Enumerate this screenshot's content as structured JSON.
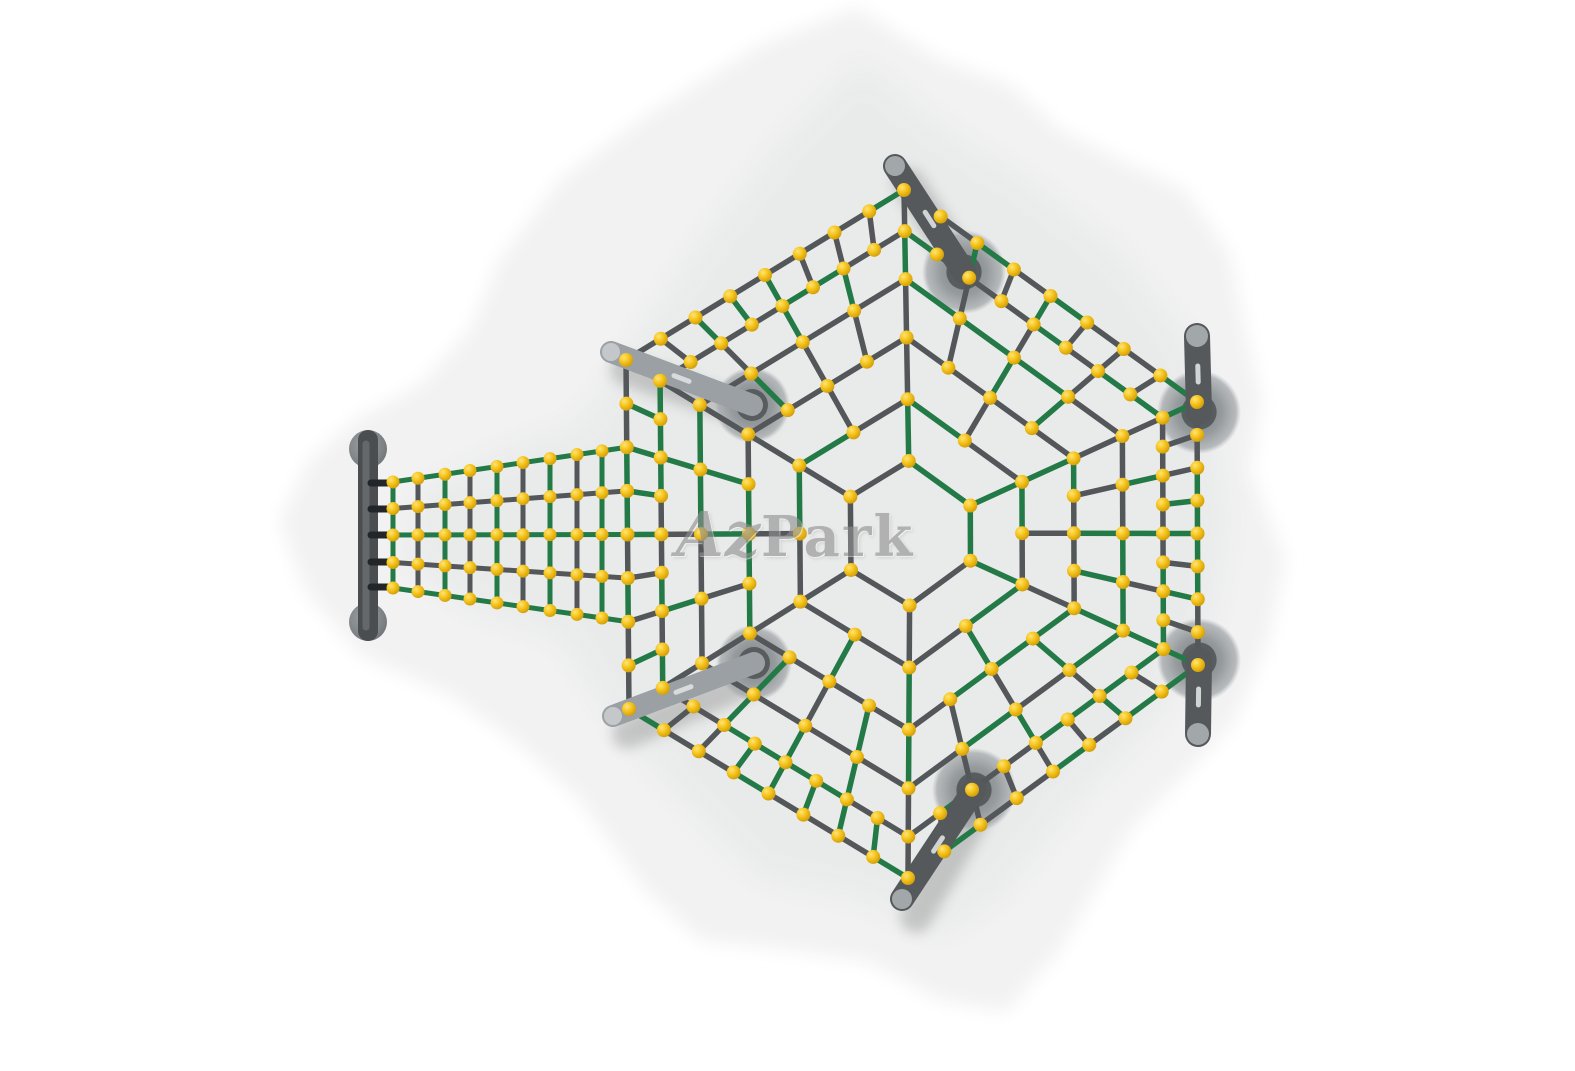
{
  "scene": {
    "watermark": {
      "script": "Az",
      "serif": "Park"
    },
    "colors": {
      "background": "#ffffff",
      "ground_outer": "#f2f2f3",
      "ground_inner": "#e9eaea",
      "rope_gray": "#53575a",
      "rope_green": "#237a47",
      "ball_light": "#ffe476",
      "ball_mid": "#f6c51f",
      "ball_dark": "#cf9a05",
      "post_dark": "#55595b",
      "post_light": "#9aa0a3",
      "post_tip": "#a7acae",
      "base_gray": "#888d8f",
      "base_hole": "#54585a",
      "bar_dark": "#4a4e50",
      "bar_sheen": "#64686a",
      "cap_gray": "#84898b",
      "clamp_black": "#232628",
      "link_silver": "#d6d8d9"
    },
    "ground": {
      "outer": [
        [
          857,
          8
        ],
        [
          940,
          60
        ],
        [
          1010,
          85
        ],
        [
          1060,
          130
        ],
        [
          1120,
          160
        ],
        [
          1185,
          190
        ],
        [
          1230,
          255
        ],
        [
          1245,
          330
        ],
        [
          1262,
          400
        ],
        [
          1250,
          470
        ],
        [
          1285,
          560
        ],
        [
          1268,
          640
        ],
        [
          1235,
          720
        ],
        [
          1180,
          780
        ],
        [
          1130,
          830
        ],
        [
          1060,
          950
        ],
        [
          1005,
          1012
        ],
        [
          940,
          1000
        ],
        [
          870,
          962
        ],
        [
          790,
          950
        ],
        [
          700,
          940
        ],
        [
          645,
          890
        ],
        [
          580,
          800
        ],
        [
          520,
          745
        ],
        [
          450,
          695
        ],
        [
          360,
          655
        ],
        [
          305,
          590
        ],
        [
          280,
          520
        ],
        [
          310,
          460
        ],
        [
          355,
          420
        ],
        [
          420,
          385
        ],
        [
          470,
          330
        ],
        [
          500,
          260
        ],
        [
          560,
          180
        ],
        [
          640,
          120
        ],
        [
          760,
          45
        ]
      ],
      "inner": [
        [
          860,
          60
        ],
        [
          950,
          130
        ],
        [
          1030,
          180
        ],
        [
          1120,
          250
        ],
        [
          1190,
          340
        ],
        [
          1215,
          420
        ],
        [
          1230,
          520
        ],
        [
          1215,
          620
        ],
        [
          1160,
          720
        ],
        [
          1080,
          800
        ],
        [
          1000,
          900
        ],
        [
          938,
          938
        ],
        [
          860,
          900
        ],
        [
          760,
          880
        ],
        [
          680,
          800
        ],
        [
          610,
          720
        ],
        [
          560,
          640
        ],
        [
          470,
          610
        ],
        [
          400,
          560
        ],
        [
          420,
          490
        ],
        [
          500,
          450
        ],
        [
          580,
          420
        ],
        [
          640,
          330
        ],
        [
          700,
          240
        ],
        [
          780,
          140
        ]
      ]
    },
    "web": {
      "center": [
        910,
        533
      ],
      "corners": [
        [
          904,
          190
        ],
        [
          1197,
          402
        ],
        [
          1198,
          665
        ],
        [
          908,
          878
        ],
        [
          629,
          709
        ],
        [
          626,
          360
        ]
      ],
      "ring_scales": [
        0.21,
        0.39,
        0.57,
        0.74,
        0.88,
        1.0
      ],
      "ring_segments": [
        1,
        2,
        4,
        4,
        8,
        8
      ],
      "subdiv": 8,
      "ball_radius": 7
    },
    "bridge": {
      "bar": {
        "x": 368,
        "y_top": 440,
        "y_bottom": 631,
        "width": 20,
        "cap_radius": 19,
        "cap_top": [
          368,
          449
        ],
        "cap_bottom": [
          368,
          622
        ]
      },
      "rope_start_x": 386,
      "edge_side": 4,
      "rows": [
        {
          "bar_y": 483,
          "edge_k": 6,
          "color": "green"
        },
        {
          "bar_y": 509,
          "edge_k": 5,
          "color": "gray"
        },
        {
          "bar_y": 535,
          "edge_k": 4,
          "color": "green"
        },
        {
          "bar_y": 562,
          "edge_k": 3,
          "color": "gray"
        },
        {
          "bar_y": 587,
          "edge_k": 2,
          "color": "green"
        }
      ],
      "columns": [
        {
          "x": 393,
          "color": "green"
        },
        {
          "x": 418,
          "color": "gray"
        },
        {
          "x": 445,
          "color": "green"
        },
        {
          "x": 470,
          "color": "gray"
        },
        {
          "x": 497,
          "color": "green"
        },
        {
          "x": 523,
          "color": "gray"
        },
        {
          "x": 550,
          "color": "green"
        },
        {
          "x": 577,
          "color": "gray"
        },
        {
          "x": 602,
          "color": "green"
        }
      ],
      "ball_radius": 6.5
    },
    "posts": [
      {
        "id": "top-post",
        "tip": [
          895,
          166
        ],
        "base": [
          964,
          272
        ],
        "width": 24,
        "tone": "dark",
        "base_r": 42,
        "tilt": true
      },
      {
        "id": "upper-left-post",
        "tip": [
          611,
          352
        ],
        "base": [
          752,
          405
        ],
        "width": 22,
        "tone": "light",
        "base_r": 38,
        "tilt": true
      },
      {
        "id": "lower-left-post",
        "tip": [
          613,
          716
        ],
        "base": [
          754,
          663
        ],
        "width": 22,
        "tone": "light",
        "base_r": 38,
        "tilt": true
      },
      {
        "id": "bottom-post",
        "tip": [
          902,
          899
        ],
        "base": [
          974,
          790
        ],
        "width": 24,
        "tone": "dark",
        "base_r": 42,
        "tilt": true
      },
      {
        "id": "upper-right-post",
        "tip": [
          1197,
          336
        ],
        "base": [
          1199,
          412
        ],
        "width": 26,
        "tone": "dark",
        "base_r": 42,
        "tilt": false
      },
      {
        "id": "lower-right-post",
        "tip": [
          1198,
          734
        ],
        "base": [
          1199,
          660
        ],
        "width": 26,
        "tone": "dark",
        "base_r": 42,
        "tilt": false
      }
    ],
    "links": [
      {
        "from": [
          904,
          190
        ],
        "to": [
          895,
          167
        ]
      },
      {
        "from": [
          626,
          360
        ],
        "to": [
          612,
          353
        ]
      },
      {
        "from": [
          629,
          709
        ],
        "to": [
          614,
          715
        ]
      },
      {
        "from": [
          908,
          878
        ],
        "to": [
          903,
          897
        ]
      }
    ]
  }
}
